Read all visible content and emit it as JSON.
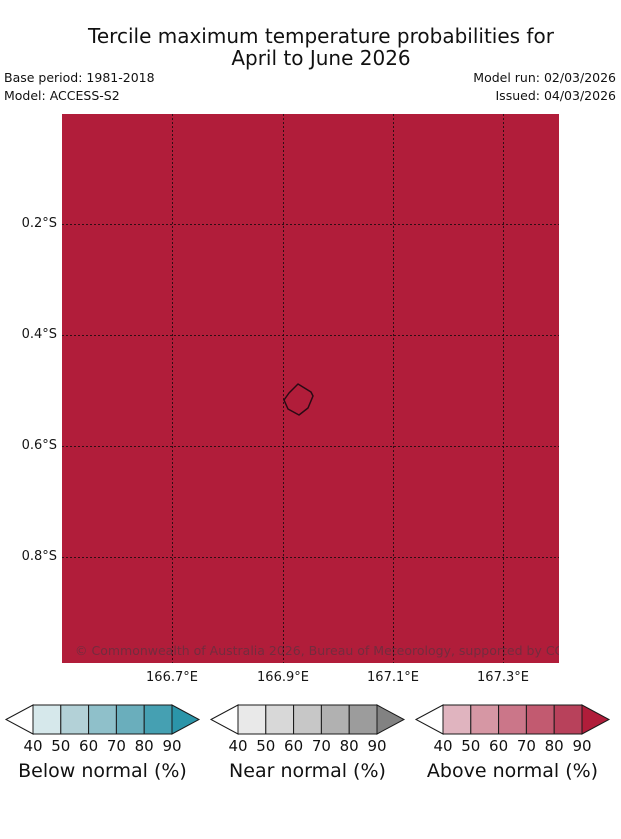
{
  "title": {
    "line1": "Tercile maximum temperature probabilities for",
    "line2": "April to June 2026"
  },
  "meta": {
    "base_period": "Base period: 1981-2018",
    "model": "Model: ACCESS-S2",
    "model_run": "Model run: 02/03/2026",
    "issued": "Issued: 04/03/2026"
  },
  "map": {
    "fill_color": "#b11d3a",
    "outline_color": "#2a0a14",
    "copyright": "© Commonwealth of Australia 2026, Bureau of Meteorology, supported by COSPPac",
    "x_ticks": [
      "166.7°E",
      "166.9°E",
      "167.1°E",
      "167.3°E"
    ],
    "y_ticks": [
      "0.2°S",
      "0.4°S",
      "0.6°S",
      "0.8°S"
    ]
  },
  "legend": {
    "bars": [
      {
        "label": "Below normal (%)",
        "ticks": [
          "40",
          "50",
          "60",
          "70",
          "80",
          "90"
        ],
        "colors": [
          "#d6e8eb",
          "#b3d1d7",
          "#8fc0ca",
          "#6aaebc",
          "#45a0b2"
        ],
        "arrow_color": "#2b95a9"
      },
      {
        "label": "Near normal (%)",
        "ticks": [
          "40",
          "50",
          "60",
          "70",
          "80",
          "90"
        ],
        "colors": [
          "#e9e9e9",
          "#d8d8d8",
          "#c7c7c7",
          "#b1b1b1",
          "#9c9c9c"
        ],
        "arrow_color": "#828282"
      },
      {
        "label": "Above normal (%)",
        "ticks": [
          "40",
          "50",
          "60",
          "70",
          "80",
          "90"
        ],
        "colors": [
          "#e0b4bf",
          "#d697a4",
          "#cb7689",
          "#c25a70",
          "#b8415b"
        ],
        "arrow_color": "#b01d3a"
      }
    ]
  },
  "chart_data": {
    "type": "heatmap",
    "title": "Tercile maximum temperature probabilities for April to June 2026",
    "region": "Nauru",
    "x_axis_label_ticks": [
      "166.7°E",
      "166.9°E",
      "167.1°E",
      "167.3°E"
    ],
    "y_axis_label_ticks": [
      "0.2°S",
      "0.4°S",
      "0.6°S",
      "0.8°S"
    ],
    "x_range_deg_east": [
      166.5,
      167.4
    ],
    "y_range_deg_south": [
      0.0,
      1.0
    ],
    "field": "probability of above-normal maximum temperature",
    "uniform_value_percent": ">90",
    "island_outline_center": {
      "lon_e": 166.93,
      "lat_s": 0.52
    },
    "legend_bins_percent": [
      40,
      50,
      60,
      70,
      80,
      90
    ],
    "legend_categories": [
      "Below normal (%)",
      "Near normal (%)",
      "Above normal (%)"
    ],
    "grid": "dotted"
  }
}
